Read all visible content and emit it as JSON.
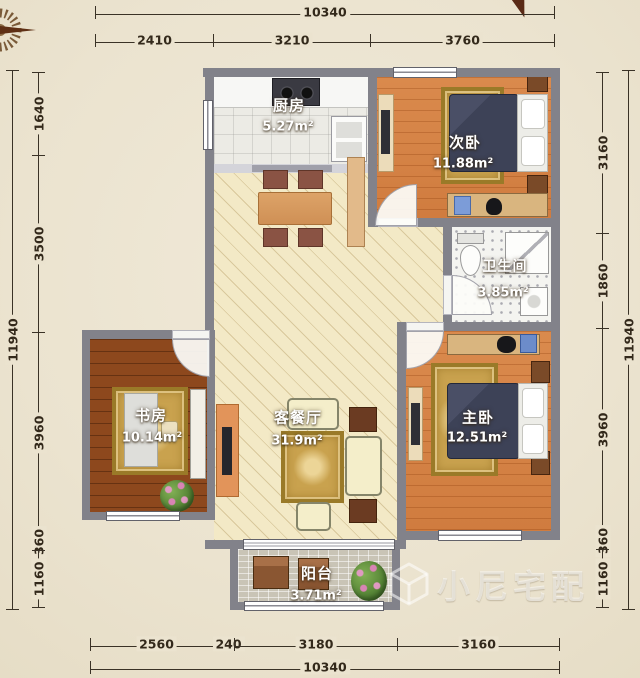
{
  "plan_title": "residential floor plan",
  "dimensions": {
    "top": {
      "total": "10340",
      "segments": [
        "2410",
        "3210",
        "3760"
      ]
    },
    "bottom": {
      "total": "10340",
      "segments": [
        "2560",
        "240",
        "3180",
        "3160"
      ]
    },
    "left": {
      "total": "11940",
      "segments": [
        "1640",
        "3500",
        "3960",
        "360",
        "1160"
      ]
    },
    "right": {
      "total": "11940",
      "segments": [
        "3160",
        "1860",
        "3960",
        "360",
        "1160"
      ]
    }
  },
  "rooms": {
    "kitchen": {
      "name": "厨房",
      "area": "5.27m²"
    },
    "second_bedroom": {
      "name": "次卧",
      "area": "11.88m²"
    },
    "bathroom": {
      "name": "卫生间",
      "area": "3.85m²"
    },
    "study": {
      "name": "书房",
      "area": "10.14m²"
    },
    "living_dining": {
      "name": "客餐厅",
      "area": "31.9m²"
    },
    "master_bedroom": {
      "name": "主卧",
      "area": "12.51m²"
    },
    "balcony": {
      "name": "阳台",
      "area": "3.71m²"
    }
  },
  "watermark": {
    "text": "小尼宅配"
  },
  "colors": {
    "page_background": "#ebe3cf",
    "wall": "#82828a",
    "wood_orange": "#d6874b",
    "wood_dark": "#8d481d",
    "living_floor": "#f3e9c6",
    "bed_navy": "#3f4358",
    "rug_gold": "#c9a24e",
    "dimension_text": "#33291b"
  }
}
